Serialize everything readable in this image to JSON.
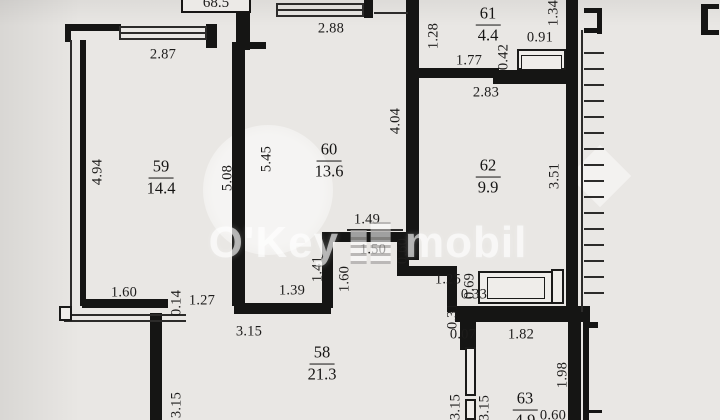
{
  "total_area_label": "68.5",
  "watermark": {
    "left": "O'Key",
    "right": "mobil"
  },
  "rooms": [
    {
      "num": "59",
      "area": "14.4",
      "x": 161,
      "y": 178
    },
    {
      "num": "60",
      "area": "13.6",
      "x": 329,
      "y": 161
    },
    {
      "num": "61",
      "area": "4.4",
      "x": 488,
      "y": 25
    },
    {
      "num": "62",
      "area": "9.9",
      "x": 488,
      "y": 177
    },
    {
      "num": "58",
      "area": "21.3",
      "x": 322,
      "y": 364
    },
    {
      "num": "63",
      "area": "4.9",
      "x": 525,
      "y": 410
    }
  ],
  "dim_labels_h": [
    {
      "text": "2.87",
      "x": 163,
      "y": 55
    },
    {
      "text": "2.88",
      "x": 331,
      "y": 29
    },
    {
      "text": "0.91",
      "x": 540,
      "y": 38
    },
    {
      "text": "1.77",
      "x": 469,
      "y": 61
    },
    {
      "text": "2.83",
      "x": 486,
      "y": 93
    },
    {
      "text": "1.49",
      "x": 367,
      "y": 220
    },
    {
      "text": "1.50",
      "x": 373,
      "y": 250
    },
    {
      "text": "1.25",
      "x": 448,
      "y": 280
    },
    {
      "text": "0.33",
      "x": 474,
      "y": 295
    },
    {
      "text": "1.60",
      "x": 124,
      "y": 293
    },
    {
      "text": "1.27",
      "x": 202,
      "y": 301
    },
    {
      "text": "1.39",
      "x": 292,
      "y": 291
    },
    {
      "text": "3.15",
      "x": 249,
      "y": 332
    },
    {
      "text": "0.07",
      "x": 463,
      "y": 335
    },
    {
      "text": "1.82",
      "x": 521,
      "y": 335
    },
    {
      "text": "0.60",
      "x": 553,
      "y": 416
    }
  ],
  "dim_labels_v": [
    {
      "text": "4.94",
      "x": 98,
      "y": 172
    },
    {
      "text": "5.08",
      "x": 228,
      "y": 178
    },
    {
      "text": "5.45",
      "x": 267,
      "y": 159
    },
    {
      "text": "4.04",
      "x": 396,
      "y": 121
    },
    {
      "text": "1.28",
      "x": 434,
      "y": 36
    },
    {
      "text": "1.34",
      "x": 554,
      "y": 13
    },
    {
      "text": "0.42",
      "x": 504,
      "y": 57
    },
    {
      "text": "3.51",
      "x": 555,
      "y": 176
    },
    {
      "text": "0.60",
      "x": 403,
      "y": 251
    },
    {
      "text": "1.41",
      "x": 318,
      "y": 269
    },
    {
      "text": "1.60",
      "x": 345,
      "y": 279
    },
    {
      "text": "0.69",
      "x": 470,
      "y": 286
    },
    {
      "text": "0.31",
      "x": 453,
      "y": 316
    },
    {
      "text": "0.14",
      "x": 177,
      "y": 303
    },
    {
      "text": "3.15",
      "x": 177,
      "y": 405
    },
    {
      "text": "3.15",
      "x": 456,
      "y": 407
    },
    {
      "text": "3.15",
      "x": 485,
      "y": 408
    },
    {
      "text": "1.98",
      "x": 563,
      "y": 375
    }
  ],
  "geometry": {
    "walls": [
      [
        65,
        24,
        56,
        7
      ],
      [
        65,
        24,
        6,
        18
      ],
      [
        206,
        24,
        11,
        24
      ],
      [
        80,
        40,
        6,
        266
      ],
      [
        232,
        42,
        13,
        264
      ],
      [
        236,
        8,
        14,
        42
      ],
      [
        236,
        42,
        30,
        7
      ],
      [
        364,
        0,
        9,
        18
      ],
      [
        406,
        0,
        13,
        260
      ],
      [
        419,
        68,
        80,
        10
      ],
      [
        493,
        70,
        82,
        14
      ],
      [
        566,
        0,
        12,
        310
      ],
      [
        322,
        232,
        11,
        76
      ],
      [
        328,
        232,
        80,
        10
      ],
      [
        397,
        242,
        12,
        30
      ],
      [
        397,
        266,
        58,
        10
      ],
      [
        447,
        266,
        10,
        46
      ],
      [
        455,
        306,
        135,
        16
      ],
      [
        234,
        300,
        9,
        14
      ],
      [
        241,
        303,
        90,
        11
      ],
      [
        82,
        299,
        86,
        9
      ],
      [
        150,
        313,
        12,
        107
      ],
      [
        568,
        322,
        13,
        98
      ],
      [
        460,
        322,
        16,
        28
      ],
      [
        584,
        8,
        18,
        5
      ],
      [
        597,
        10,
        5,
        24
      ],
      [
        584,
        28,
        18,
        5
      ],
      [
        701,
        4,
        7,
        31
      ],
      [
        701,
        4,
        18,
        5
      ],
      [
        701,
        30,
        18,
        5
      ],
      [
        583,
        322,
        15,
        6
      ],
      [
        583,
        322,
        6,
        98
      ],
      [
        589,
        410,
        13,
        3
      ]
    ],
    "thin": [
      [
        70,
        40,
        2,
        266
      ],
      [
        121,
        26,
        86,
        2
      ],
      [
        121,
        32,
        86,
        2
      ],
      [
        121,
        38,
        86,
        2
      ],
      [
        119,
        26,
        2,
        14
      ],
      [
        205,
        26,
        2,
        14
      ],
      [
        278,
        3,
        86,
        2
      ],
      [
        278,
        9,
        86,
        2
      ],
      [
        278,
        15,
        86,
        2
      ],
      [
        276,
        3,
        2,
        14
      ],
      [
        362,
        3,
        2,
        14
      ],
      [
        374,
        12,
        34,
        2
      ],
      [
        64,
        314,
        122,
        2
      ],
      [
        64,
        320,
        122,
        2
      ],
      [
        347,
        229,
        56,
        2
      ],
      [
        581,
        30,
        2,
        282
      ]
    ],
    "fixtures": [
      [
        478,
        271,
        86,
        33
      ],
      [
        551,
        269,
        13,
        35
      ],
      [
        517,
        49,
        49,
        21
      ],
      [
        465,
        347,
        11,
        49
      ],
      [
        465,
        399,
        11,
        21
      ],
      [
        59,
        306,
        13,
        15
      ]
    ],
    "fixtures_inner": [
      [
        487,
        277,
        58,
        22
      ],
      [
        521,
        55,
        41,
        15
      ]
    ],
    "hatch": {
      "x": 584,
      "len": 20,
      "y0": 52,
      "y1": 298,
      "step": 16
    }
  },
  "colors": {
    "wall": "#151514",
    "paper": "#e9e7e4",
    "text": "#1d1c1b",
    "watermark": "rgba(255,255,255,0.62)"
  }
}
